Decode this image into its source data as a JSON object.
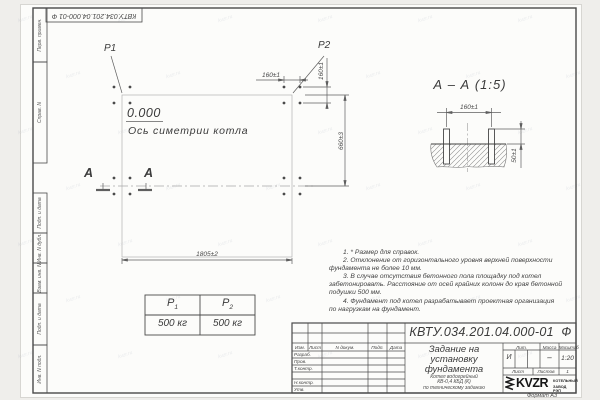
{
  "watermark": "kvzr.ru",
  "stamp_top": "КВТУ.034.201.04.000-01  Ф",
  "margin_labels": [
    "Перв. примен.",
    "Справ. N",
    "Подп. и дата",
    "Инв. N дубл.",
    "Взам. инв. N",
    "Подп. и дата",
    "Инв. N подл."
  ],
  "plan": {
    "p1": "P1",
    "p2": "P2",
    "elevation": "0.000",
    "axis_label": "Ось симетрии котла",
    "section_letter": "А",
    "dim_bolt_spacing": "160±1",
    "dim_width": "1805±2",
    "dim_height": "660±3"
  },
  "section_view": {
    "title": "А – А (1:5)",
    "dim_spacing": "160±1",
    "dim_depth": "50±1"
  },
  "loads_table": {
    "col1_base": "P",
    "col1_sub": "1",
    "col2_base": "P",
    "col2_sub": "2",
    "value1": "500 кг",
    "value2": "500 кг"
  },
  "notes": {
    "lines": [
      "1. * Размер для справок.",
      "2. Отклонение от горизонтального уровня верхней поверхности",
      "фундамента не более 10 мм.",
      "3. В случае отсутствия бетонного пола площадку под котел",
      "забетонировать. Расстояние от осей крайних колонн до края бетонной",
      "подушки 500 мм.",
      "4. Фундамент под котел разрабатывает проектная организация",
      "по нагрузкам на фундамент."
    ]
  },
  "title_block": {
    "designation": "КВТУ.034.201.04.000-01  Ф",
    "doc_title_lines": [
      "Задание на",
      "установку",
      "фундамента"
    ],
    "product_lines": [
      "Котел водогрейный",
      "КВ-0,4 КБД (К)",
      "по техническому заданию"
    ],
    "rev_headers": [
      "Изм.",
      "Лист",
      "N докум.",
      "Подп.",
      "Дата"
    ],
    "sig_rows": [
      "Разраб.",
      "Пров.",
      "Т.контр.",
      "",
      "Н.контр.",
      "Утв."
    ],
    "lit_header": "Лит.",
    "lit_value": "И",
    "mass_header": "Масса",
    "mass_value": "–",
    "scale_header": "Масштаб",
    "scale_value": "1:20",
    "sheet_header": "Лист",
    "sheets_header": "Листов",
    "sheets_value": "1",
    "logo_text": "KVZR",
    "logo_line1": "КОТЕЛЬНЫЙ",
    "logo_line2": "ЗАВОД РЭП",
    "format_label": "Формат А3"
  }
}
